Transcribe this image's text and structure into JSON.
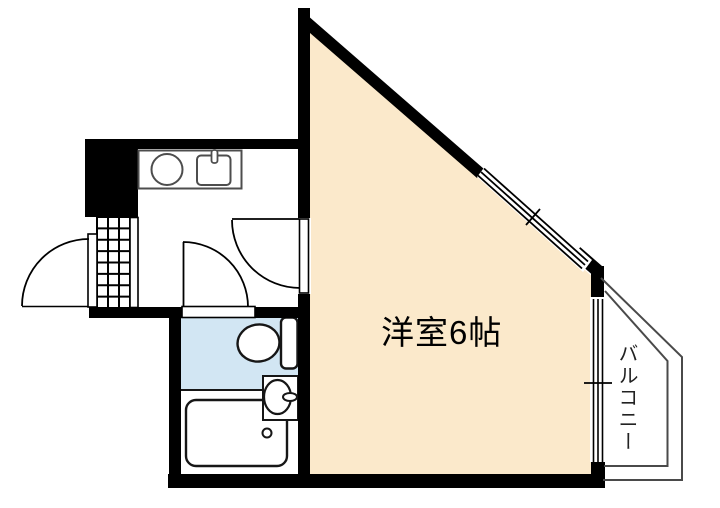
{
  "floorplan": {
    "main_room": {
      "label": "洋室6帖"
    },
    "balcony": {
      "label": "バルコニー"
    },
    "colors": {
      "room_floor": "#FBE9CB",
      "wet_area_floor": "#D2E6F3",
      "wall": "#000000",
      "counter_outline": "#4D4D4D",
      "fixture_outline": "#161616",
      "balcony_outline": "#4A4A4A"
    }
  }
}
